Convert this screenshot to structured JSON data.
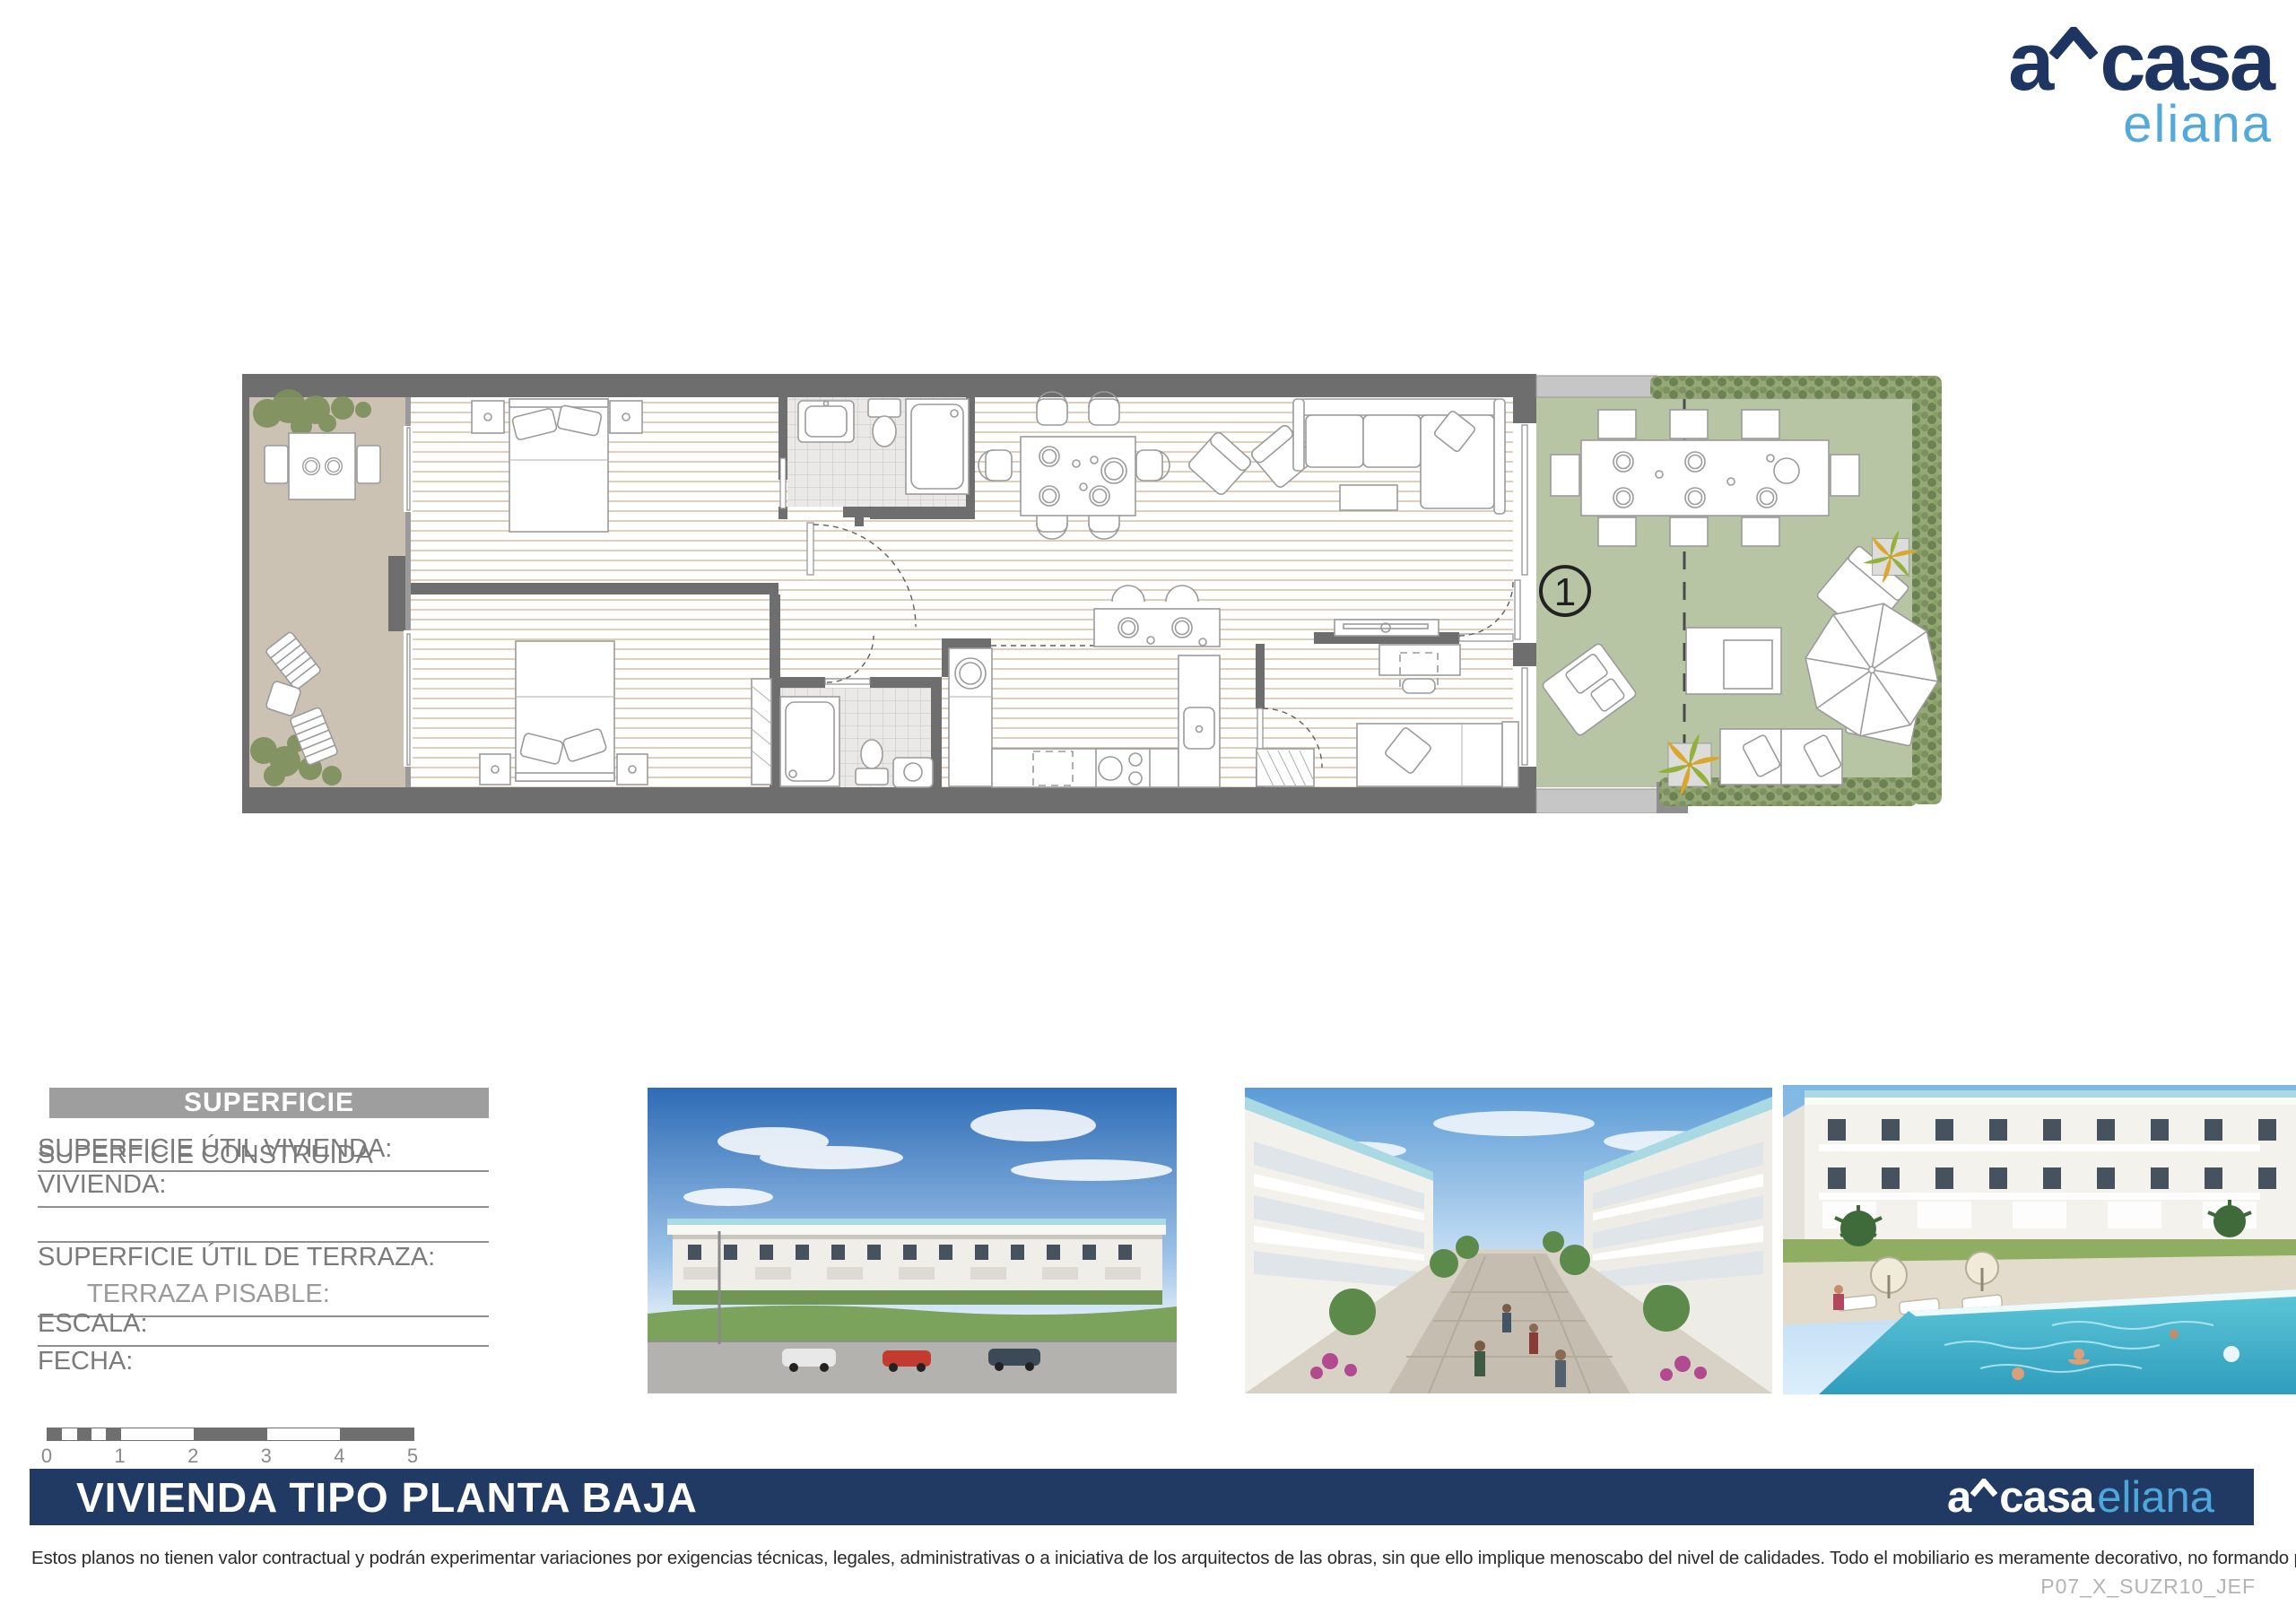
{
  "brand": {
    "prefix": "a",
    "main": "casa",
    "sub": "eliana",
    "navy": "#203a64",
    "light_blue": "#4da7dc"
  },
  "plan": {
    "unit_number": "1",
    "colors": {
      "wall_gray": "#6e6e6e",
      "terrace_floor": "#cbc2b4",
      "garden_floor": "#b7c5a5",
      "wood_line": "#d8c5a8",
      "hedge_green": "#96a777",
      "palm_yellow": "#d9a72e",
      "palm_green": "#93b13a"
    }
  },
  "surface_panel": {
    "title": "SUPERFICIE",
    "header_gray": "#9e9e9e",
    "rows": [
      {
        "label": "SUPERFICIE ÚTIL VIVIENDA:"
      },
      {
        "label": "SUPERFICIE CONSTRUIDA VIVIENDA:"
      },
      {
        "label": ""
      },
      {
        "label": "SUPERFICIE ÚTIL DE TERRAZA:"
      },
      {
        "label": "TERRAZA PISABLE:"
      },
      {
        "label": "ESCALA:"
      },
      {
        "label": "FECHA:"
      }
    ]
  },
  "scale_bar": {
    "ticks": [
      "0",
      "1",
      "2",
      "3",
      "4",
      "5"
    ]
  },
  "title_bar": {
    "title": "VIVIENDA TIPO PLANTA BAJA"
  },
  "footer": {
    "disclaimer": "Estos planos no tienen valor contractual y podrán experimentar variaciones por exigencias técnicas, legales, administrativas o a iniciativa de los arquitectos de las obras, sin que ello implique menoscabo del nivel de calidades. Todo el mobiliario es meramente decorativo, no formando parte del proyecto ni de la memoria de calidades.",
    "doc_code": "P07_X_SUZR10_JEF"
  }
}
